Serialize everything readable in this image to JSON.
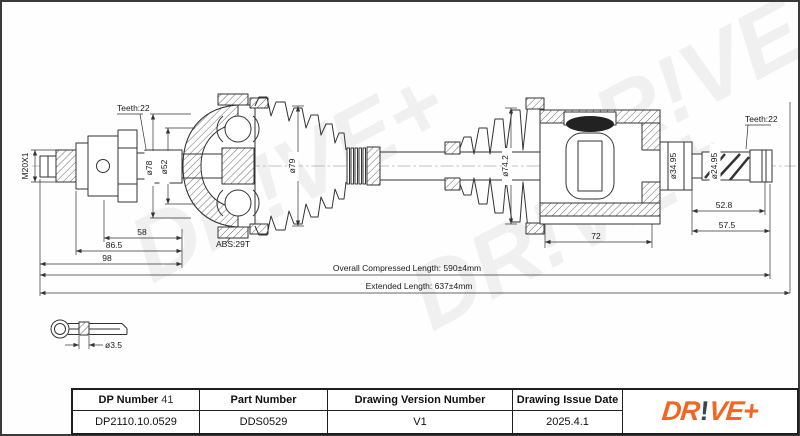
{
  "drawing": {
    "watermark_text": "DR!VE+",
    "labels": {
      "thread_spec": "M20X1",
      "teeth_left": "Teeth:22",
      "dia_bell_outer": "ø78",
      "dia_bell_inner": "ø52",
      "dia_boot_left": "ø79",
      "abs_ring": "ABS:29T",
      "dim_58": "58",
      "dim_86_5": "86.5",
      "dim_98": "98",
      "dia_boot_right": "ø74.2",
      "dim_72": "72",
      "dia_stub_ring": "ø34.95",
      "dia_spline_right": "ø24.95",
      "teeth_right": "Teeth:22",
      "dim_52_8": "52.8",
      "dim_57_5": "57.5",
      "overall_compressed": "Overall Compressed Length: 590±4mm",
      "extended": "Extended Length: 637±4mm",
      "pin_diameter": "ø3.5"
    }
  },
  "title_block": {
    "dp_number_label": "DP Number",
    "dp_number_suffix": "41",
    "dp_number_value": "DP2110.10.0529",
    "part_number_label": "Part Number",
    "part_number_value": "DDS0529",
    "version_label": "Drawing Version Number",
    "version_value": "V1",
    "issue_date_label": "Drawing Issue Date",
    "issue_date_value": "2025.4.1",
    "logo": {
      "first": "DR",
      "bang": "!",
      "second": "VE+",
      "brand_color": "#F26522",
      "bang_color": "#3E4448"
    }
  }
}
